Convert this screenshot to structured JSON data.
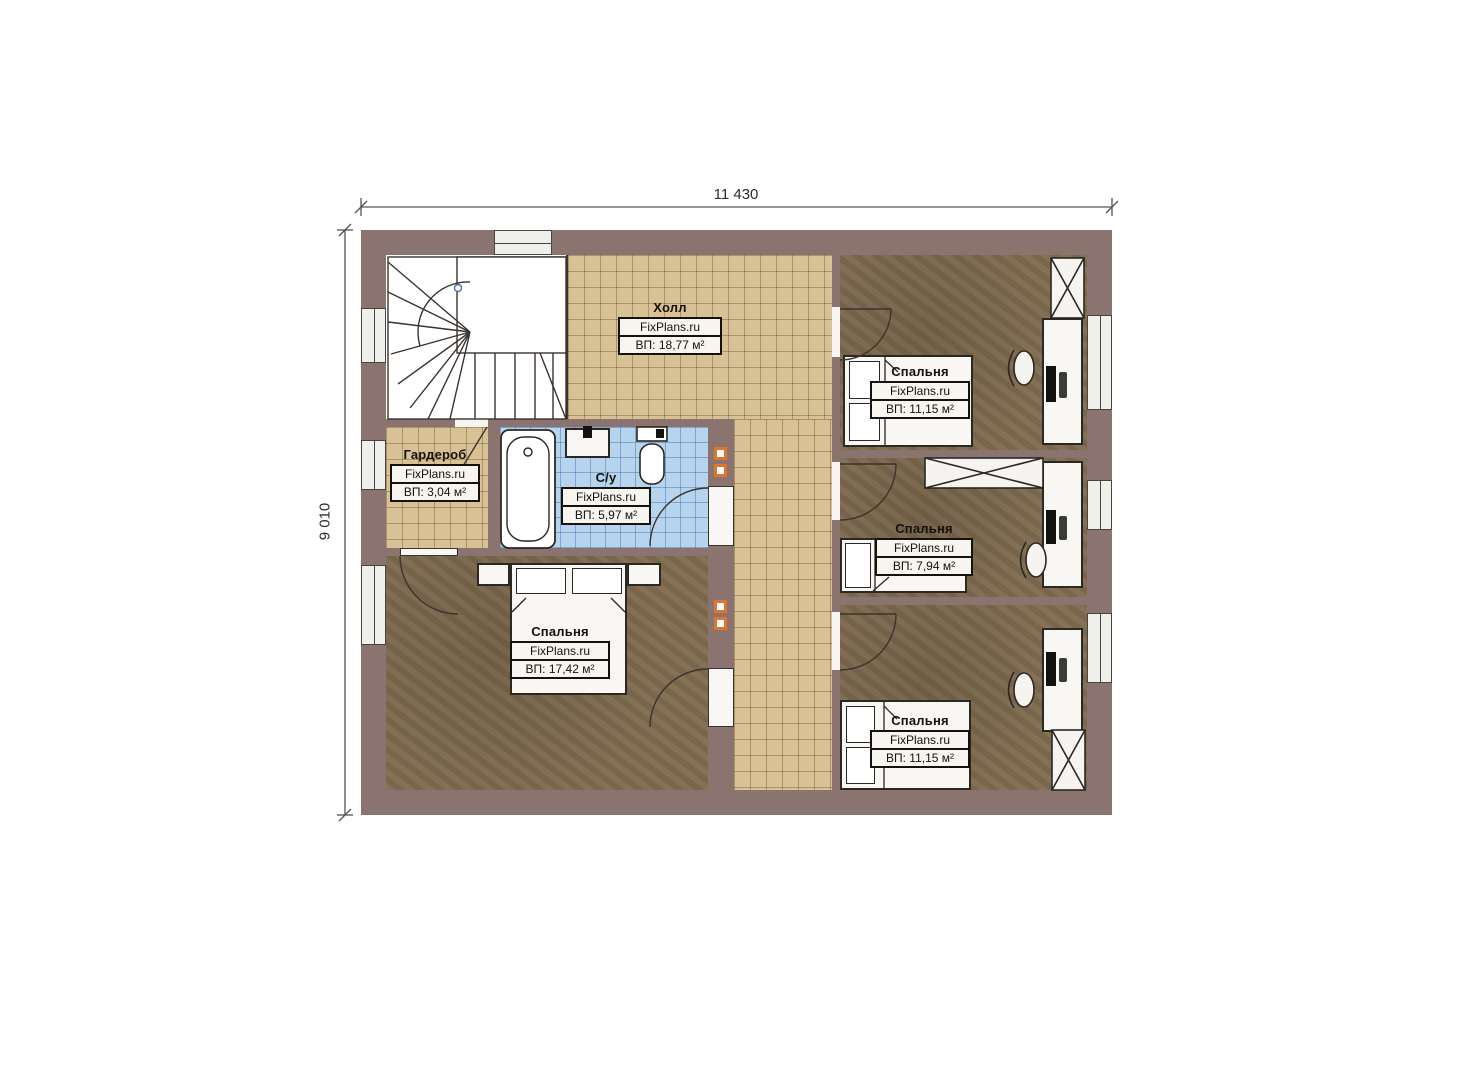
{
  "page": {
    "type": "floor-plan",
    "background": "#ffffff"
  },
  "dimensions": {
    "width_label": "11 430",
    "height_label": "9 010"
  },
  "brand": "FixPlans.ru",
  "rooms": [
    {
      "id": "hall",
      "name": "Холл",
      "brand": "FixPlans.ru",
      "area": "ВП: 18,77 м²"
    },
    {
      "id": "wardrobe",
      "name": "Гардероб",
      "brand": "FixPlans.ru",
      "area": "ВП: 3,04 м²"
    },
    {
      "id": "bathroom",
      "name": "С/у",
      "brand": "FixPlans.ru",
      "area": "ВП: 5,97 м²"
    },
    {
      "id": "bedroom-master",
      "name": "Спальня",
      "brand": "FixPlans.ru",
      "area": "ВП: 17,42 м²"
    },
    {
      "id": "bedroom-top-right",
      "name": "Спальня",
      "brand": "FixPlans.ru",
      "area": "ВП: 11,15 м²"
    },
    {
      "id": "bedroom-middle-right",
      "name": "Спальня",
      "brand": "FixPlans.ru",
      "area": "ВП: 7,94 м²"
    },
    {
      "id": "bedroom-bottom-right",
      "name": "Спальня",
      "brand": "FixPlans.ru",
      "area": "ВП: 11,15 м²"
    }
  ],
  "colors": {
    "wall": "#8b7370",
    "tile_floor": "#d8c194",
    "bathroom_floor": "#b6d4ee",
    "bedroom_floor": "#7f6b4f",
    "vent_shaft": "#e0762e"
  }
}
